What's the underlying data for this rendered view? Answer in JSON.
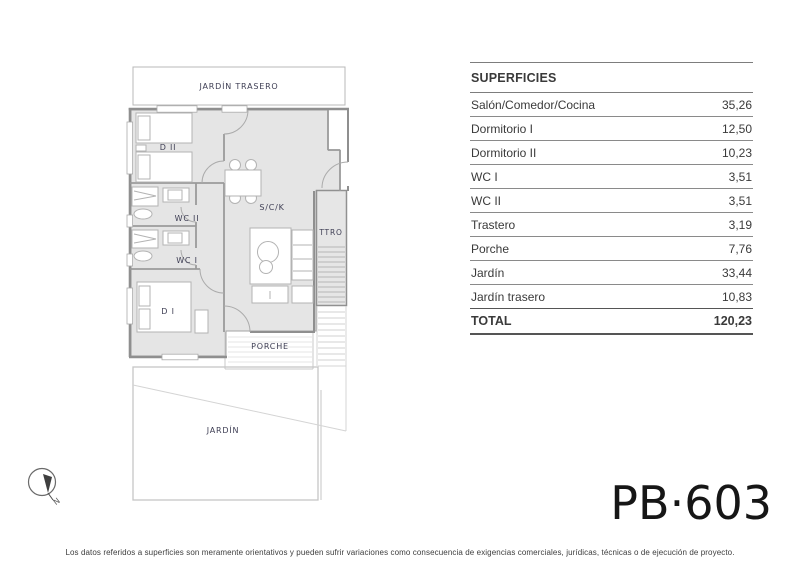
{
  "unit": {
    "code": "PB·603"
  },
  "surfaces_table": {
    "title": "SUPERFICIES",
    "rows": [
      {
        "label": "Salón/Comedor/Cocina",
        "value": "35,26"
      },
      {
        "label": "Dormitorio I",
        "value": "12,50"
      },
      {
        "label": "Dormitorio II",
        "value": "10,23"
      },
      {
        "label": "WC I",
        "value": "3,51"
      },
      {
        "label": "WC II",
        "value": "3,51"
      },
      {
        "label": "Trastero",
        "value": "3,19"
      },
      {
        "label": "Porche",
        "value": "7,76"
      },
      {
        "label": "Jardín",
        "value": "33,44"
      },
      {
        "label": "Jardín trasero",
        "value": "10,83"
      }
    ],
    "total": {
      "label": "TOTAL",
      "value": "120,23"
    }
  },
  "floor_plan": {
    "room_labels": {
      "jardin_trasero": "JARDÍN TRASERO",
      "dormitorio_2": "D II",
      "wc_2": "WC II",
      "wc_1": "WC I",
      "dormitorio_1": "D I",
      "salon_comedor_cocina": "S/C/K",
      "trastero": "TTRO",
      "porche": "PORCHE",
      "jardin": "JARDÍN"
    },
    "compass": {
      "north_label": "N"
    }
  },
  "footer": {
    "disclaimer": "Los datos referidos a superficies son meramente orientativos y pueden sufrir variaciones como consecuencia de exigencias comerciales, jurídicas, técnicas o de ejecución de proyecto."
  },
  "colors": {
    "floor_fill": "#e5e5e5",
    "wall": "#8f8f8f",
    "room_label": "#3e3e54",
    "table_text": "#3a3a3a",
    "table_line": "#8a8a8a"
  }
}
